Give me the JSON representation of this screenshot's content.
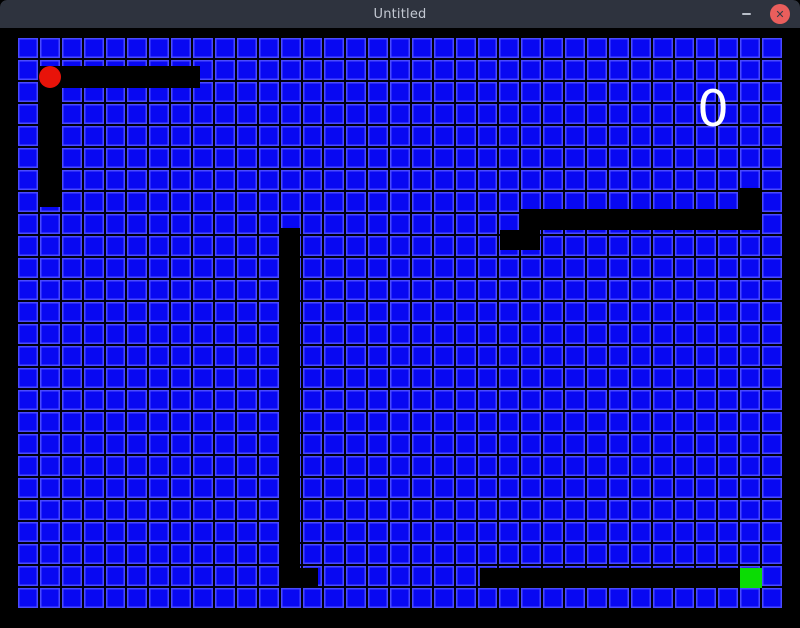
{
  "window": {
    "title": "Untitled",
    "controls": {
      "minimize_icon": "minimize-dash",
      "close_label": "✕"
    }
  },
  "theme": {
    "titlebar_bg": "#2e333e",
    "title_color": "#c3c8d2",
    "close_bg": "#ea5e5c",
    "close_x_color": "#343b47",
    "minimize_color": "#b9bfc9",
    "frame_bg": "#000000",
    "cell_color": "#0808f2",
    "cell_edge_color": "#4a4aff",
    "gridline_color": "#000010",
    "wall_color": "#000000",
    "apple_color": "#e81309",
    "head_color": "#0bdc04",
    "score_color": "#ffffff"
  },
  "game": {
    "score": "0",
    "grid": {
      "cols": 35,
      "rows": 26
    },
    "board_px": {
      "left": 18,
      "top": 10,
      "width": 764,
      "height": 570
    },
    "segments": [
      {
        "name": "top-left-horizontal-wall",
        "x": 22,
        "y": 28,
        "w": 160,
        "h": 22
      },
      {
        "name": "top-left-vertical-wall",
        "x": 22,
        "y": 28,
        "w": 22,
        "h": 141
      },
      {
        "name": "middle-vertical-wall",
        "x": 262,
        "y": 190,
        "w": 20,
        "h": 359
      },
      {
        "name": "middle-wall-foot",
        "x": 262,
        "y": 530,
        "w": 38,
        "h": 19
      },
      {
        "name": "right-wall-step",
        "x": 482,
        "y": 192,
        "w": 40,
        "h": 20
      },
      {
        "name": "right-horizontal-wall",
        "x": 502,
        "y": 171,
        "w": 242,
        "h": 21
      },
      {
        "name": "right-wall-top-cell",
        "x": 722,
        "y": 150,
        "w": 22,
        "h": 22
      },
      {
        "name": "snake-body-bar",
        "x": 462,
        "y": 530,
        "w": 260,
        "h": 20
      }
    ],
    "apple": {
      "x": 21,
      "y": 28,
      "w": 22,
      "h": 22
    },
    "head": {
      "x": 722,
      "y": 530,
      "w": 22,
      "h": 20
    },
    "score_pos": {
      "x": 667,
      "y": 44,
      "w": 56
    }
  }
}
